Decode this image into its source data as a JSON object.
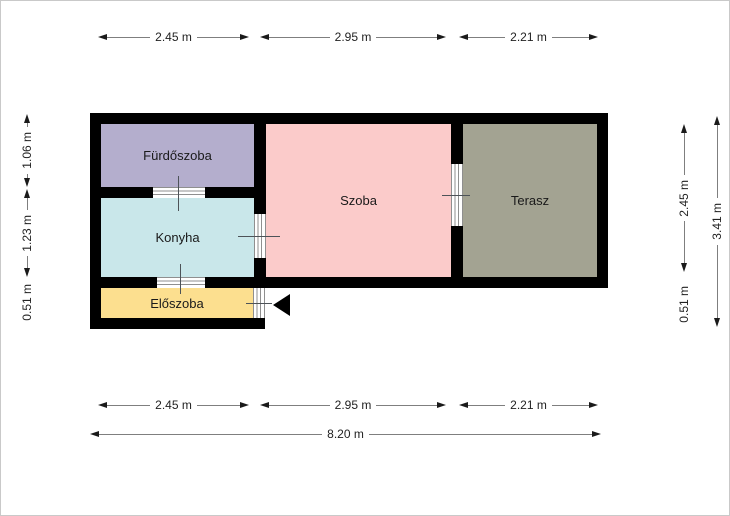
{
  "rooms": [
    {
      "name": "Fürdőszoba",
      "color": "#b4aecd"
    },
    {
      "name": "Konyha",
      "color": "#c9e7ea"
    },
    {
      "name": "Előszoba",
      "color": "#fcdf8f"
    },
    {
      "name": "Szoba",
      "color": "#fbcbca"
    },
    {
      "name": "Terasz",
      "color": "#a3a392"
    }
  ],
  "dimensions": {
    "top": [
      "2.45 m",
      "2.95 m",
      "2.21 m"
    ],
    "bottom": [
      "2.45 m",
      "2.95 m",
      "2.21 m"
    ],
    "total_width": "8.20 m",
    "left": [
      "1.06 m",
      "1.23 m",
      "0.51 m"
    ],
    "right": [
      "2.45 m",
      "0.51 m"
    ],
    "total_height": "3.41 m"
  },
  "colors": {
    "wall": "#000000",
    "dimension_line": "#7f7f7f",
    "arrowhead": "#1a1a1a",
    "label_text": "#222222"
  },
  "icons": {
    "entrance_arrow": "left-pointing-triangle"
  }
}
